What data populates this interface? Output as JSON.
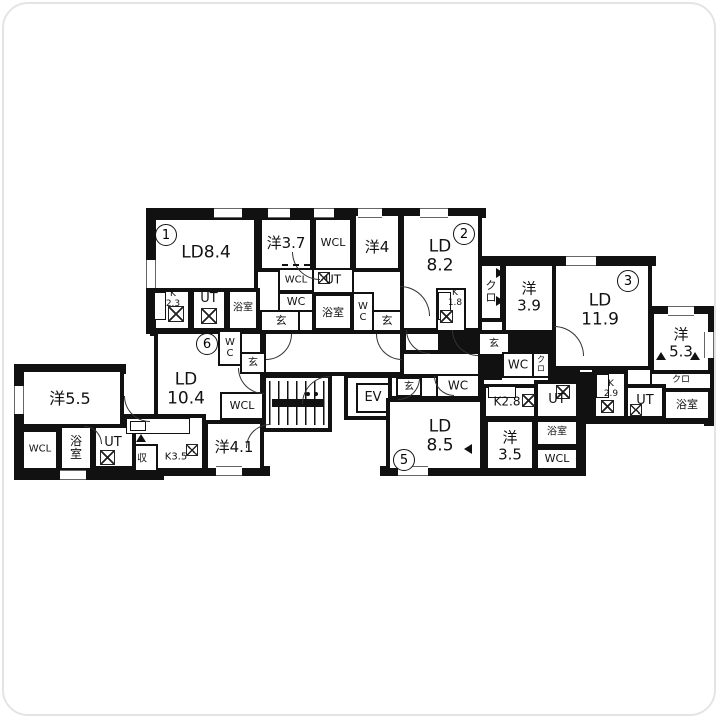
{
  "plan": {
    "type": "apartment-floor-plan",
    "wall_color": "#111111",
    "background": "#ffffff",
    "unit_numbers": {
      "u1": "1",
      "u2": "2",
      "u3": "3",
      "u5": "5",
      "u6": "6"
    }
  },
  "labels": {
    "ld84": "LD8.4",
    "yo37": "洋3.7",
    "wcl1": "WCL",
    "yo4": "洋4",
    "k23": "K\n2.3",
    "ut1": "UT",
    "bath1": "浴室",
    "wcl2": "WCL",
    "ut2": "UT",
    "wc1": "WC",
    "gen1": "玄",
    "bath2": "浴室",
    "wc2": "W\nC",
    "gen2": "玄",
    "ld82": "LD\n8.2",
    "k18": "K\n1.8",
    "kuro1": "ク\nロ",
    "yo39": "洋\n3.9",
    "gen3": "玄",
    "wc3": "WC",
    "kuro3": "ク\nロ",
    "ld119": "LD\n11.9",
    "yo53": "洋\n5.3",
    "kuro2": "クロ",
    "k29": "K\n2.9",
    "ut3": "UT",
    "bath3": "浴室",
    "ev": "EV",
    "gen4": "玄",
    "wc4": "WC",
    "ld85": "LD\n8.5",
    "k28": "K2.8",
    "yo35": "洋\n3.5",
    "ut4": "UT",
    "bath4": "浴室",
    "wcl3": "WCL",
    "wc5": "W\nC",
    "gen5": "玄",
    "ld104": "LD\n10.4",
    "wcl4": "WCL",
    "yo41": "洋4.1",
    "k35": "K3.5",
    "shu": "収",
    "yo55": "洋5.5",
    "wcl5": "WCL",
    "bath5": "浴\n室",
    "ut5": "UT"
  }
}
